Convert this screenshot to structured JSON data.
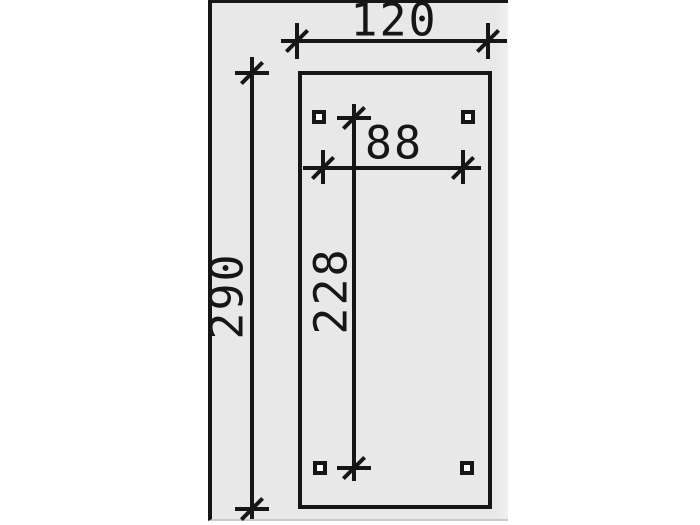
{
  "dimension_labels": {
    "outer_width": "120",
    "outer_height": "290",
    "inner_width": "88",
    "inner_height": "228"
  },
  "colors": {
    "line": "#161616",
    "panel_background": "#e8e8e8",
    "page_background": "#ffffff",
    "post_fill": "#ffffff",
    "panel_bottom_edge": "#c9c9c9"
  }
}
